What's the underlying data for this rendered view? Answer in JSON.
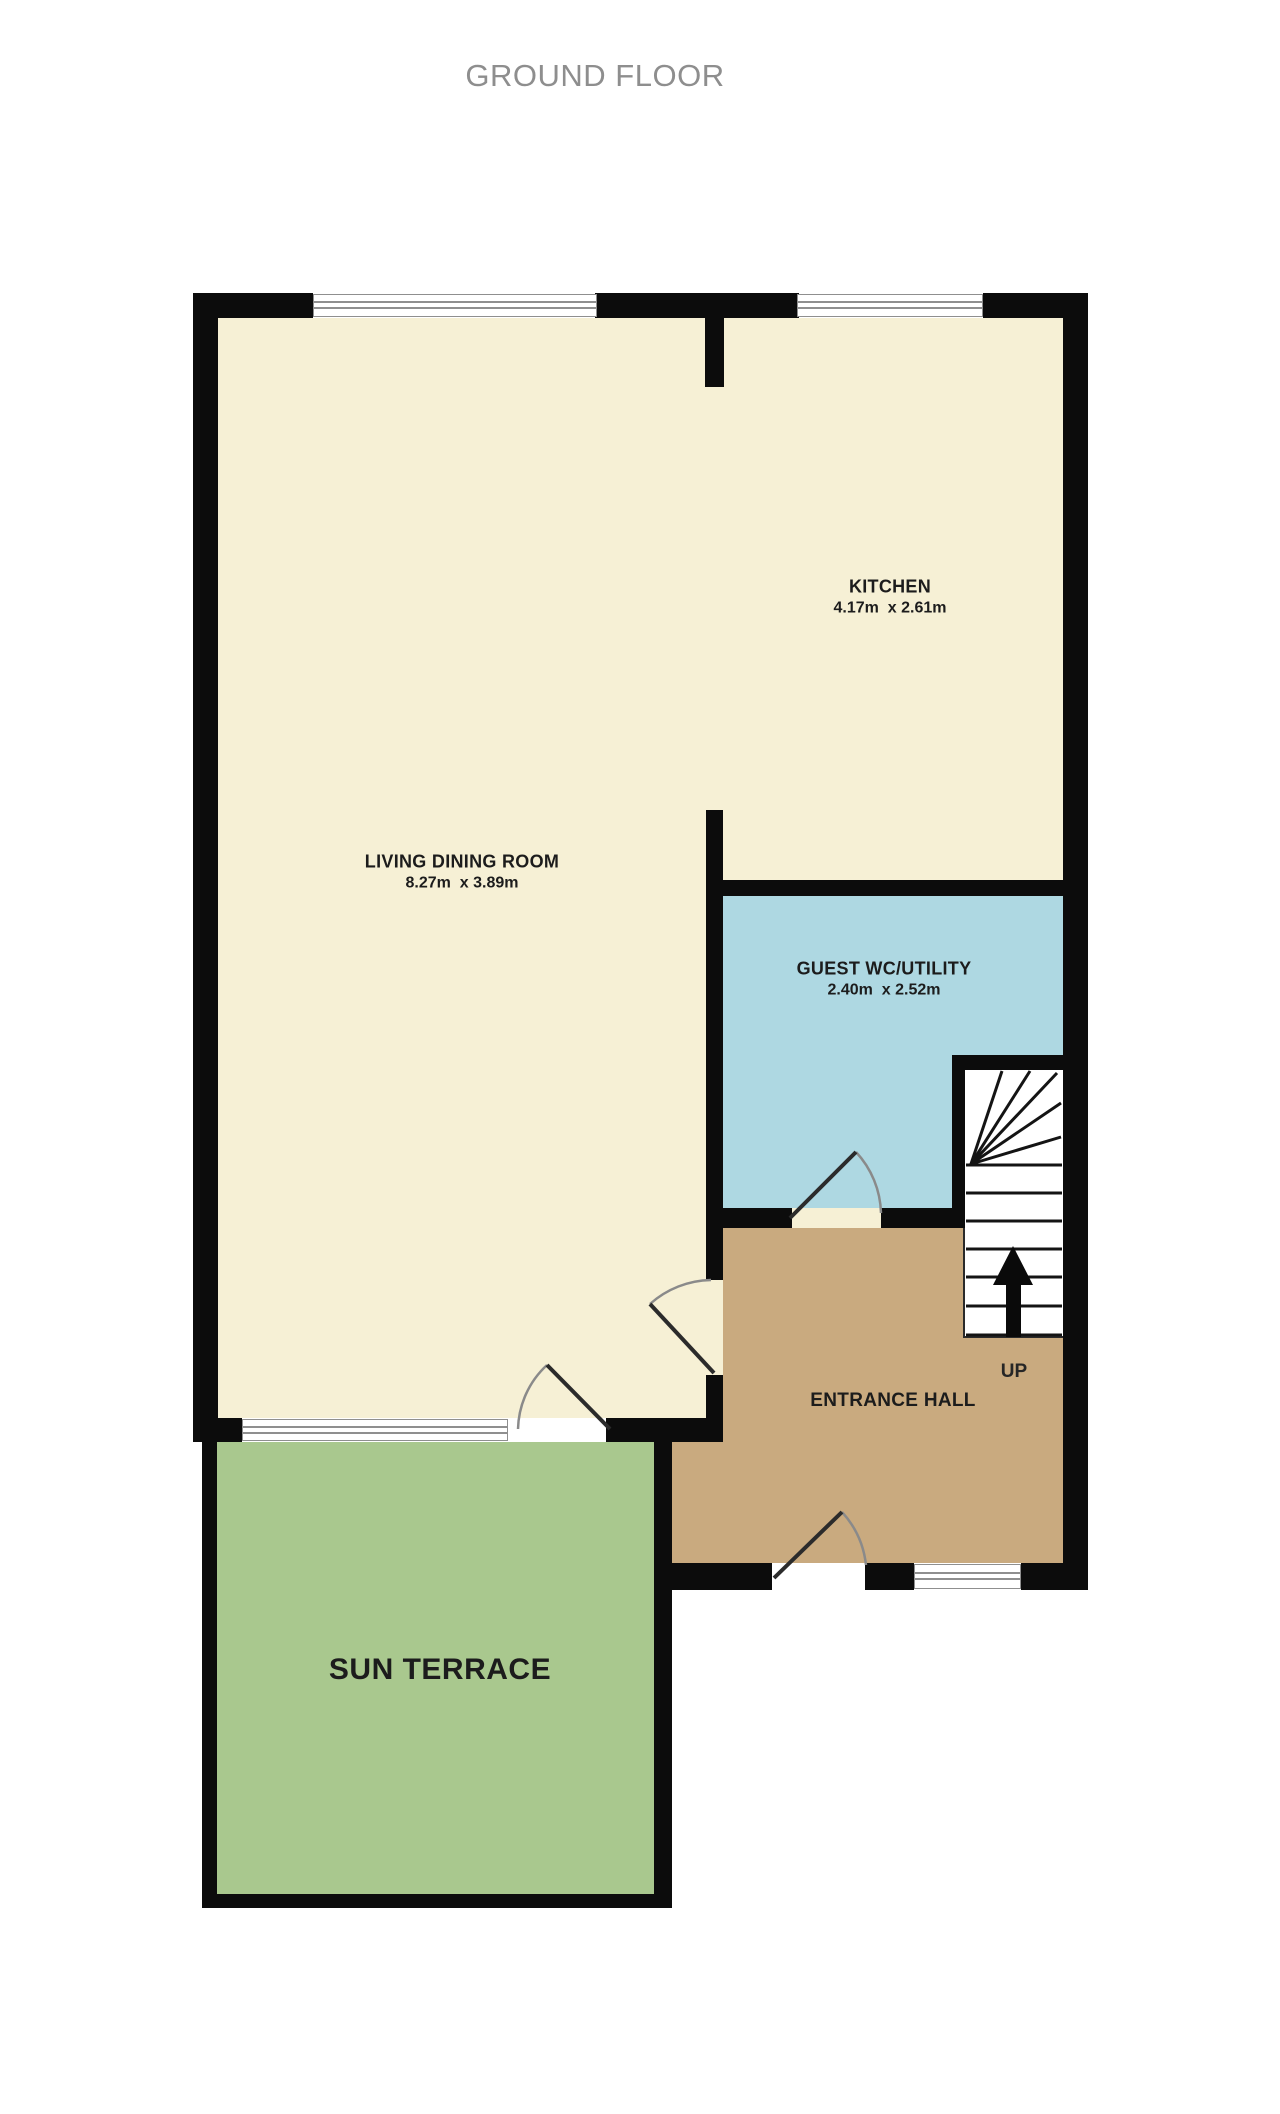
{
  "title": "GROUND FLOOR",
  "rooms": {
    "living": {
      "name": "LIVING DINING ROOM",
      "dims": "8.27m  x 3.89m"
    },
    "kitchen": {
      "name": "KITCHEN",
      "dims": "4.17m  x 2.61m"
    },
    "wc": {
      "name": "GUEST WC/UTILITY",
      "dims": "2.40m  x 2.52m"
    },
    "hall": {
      "name": "ENTRANCE HALL"
    },
    "terrace": {
      "name": "SUN TERRACE"
    }
  },
  "stairs": {
    "label": "UP"
  },
  "colors": {
    "floor_cream": "#f6f0d5",
    "wc_blue": "#aed8e2",
    "hall_tan": "#c9aa7f",
    "terrace_green": "#a9c88e",
    "wall_black": "#0c0c0c",
    "window_line_gray": "#8f8f8f",
    "title_gray": "#8e8e8e",
    "label_dark": "#1c1c1c"
  }
}
